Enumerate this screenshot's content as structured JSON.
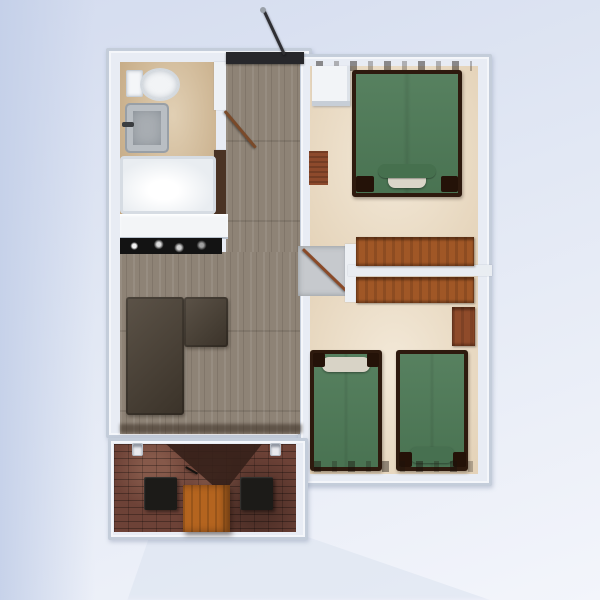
{
  "meta": {
    "view": "top-down-floorplan-render",
    "canvas": {
      "width": 600,
      "height": 600
    }
  },
  "palette": {
    "background_top": "#d4dcef",
    "background_bottom": "#f3f5fb",
    "wall_outer": "#c4cdda",
    "wall_inner": "#eef1f6",
    "bathroom_floor": "#d5bd97",
    "wood_floor": "#8e8376",
    "carpet": "#eee0c9",
    "brick": "#6d4237",
    "bed_green": "#4e7a57",
    "bed_frame": "#2e1a0e",
    "dresser_wood": "#a05726",
    "sofa_brown": "#493f33",
    "table_orange": "#b4641f",
    "chair_black": "#1c1b18",
    "counter_black": "#131313",
    "fixture_white": "#f3f5f8"
  },
  "rooms": [
    {
      "name": "bathroom",
      "fixtures": [
        "toilet",
        "sink",
        "bathtub"
      ]
    },
    {
      "name": "living-room",
      "fixtures": [
        "sofa-sectional",
        "kitchen-counter"
      ]
    },
    {
      "name": "bedroom-top",
      "fixtures": [
        "double-bed",
        "white-dresser",
        "long-dresser",
        "small-rug"
      ]
    },
    {
      "name": "bedroom-bottom",
      "fixtures": [
        "single-bed-left",
        "single-bed-right",
        "long-dresser",
        "nightstand"
      ]
    },
    {
      "name": "patio",
      "fixtures": [
        "square-table",
        "chair-left",
        "chair-right",
        "wall-lamp-left",
        "wall-lamp-right"
      ]
    }
  ],
  "scene": {
    "items": [
      {
        "name": "background",
        "kind": "bg-main",
        "x": 0,
        "y": 0,
        "w": 600,
        "h": 600,
        "interactable": false
      },
      {
        "name": "background-left-band",
        "kind": "bg-left-band",
        "x": 0,
        "y": 0,
        "w": 95,
        "h": 600,
        "opacity": 0.9,
        "interactable": false
      },
      {
        "name": "ground-shadow",
        "kind": "ground-shadow",
        "x": 120,
        "y": 536,
        "w": 370,
        "h": 64,
        "color": "#dfe5f1",
        "opacity": 0.7,
        "interactable": false
      },
      {
        "name": "living-block-walls",
        "kind": "block",
        "x": 106,
        "y": 48,
        "w": 206,
        "h": 390,
        "interactable": false
      },
      {
        "name": "bedroom-block-walls",
        "kind": "block",
        "x": 298,
        "y": 54,
        "w": 194,
        "h": 432,
        "interactable": false
      },
      {
        "name": "patio-walls",
        "kind": "block",
        "x": 108,
        "y": 438,
        "w": 200,
        "h": 102,
        "interactable": false
      },
      {
        "name": "bathroom-floor",
        "kind": "floor-tile",
        "x": 120,
        "y": 62,
        "w": 96,
        "h": 152,
        "color": "#d5bd97",
        "interactable": false
      },
      {
        "name": "hallway-wood-floor",
        "kind": "floor-wood",
        "x": 226,
        "y": 62,
        "w": 74,
        "h": 372,
        "color": "#8e8376",
        "interactable": false
      },
      {
        "name": "living-wood-floor",
        "kind": "floor-wood",
        "x": 120,
        "y": 252,
        "w": 180,
        "h": 182,
        "color": "#8e8376",
        "interactable": false
      },
      {
        "name": "bathroom-wall-segment",
        "kind": "wall",
        "x": 214,
        "y": 62,
        "w": 12,
        "h": 48,
        "color": "#eef1f5",
        "interactable": false
      },
      {
        "name": "bathroom-cabinet-strip",
        "kind": "wall",
        "x": 214,
        "y": 150,
        "w": 12,
        "h": 64,
        "color": "#4a3324",
        "interactable": true
      },
      {
        "name": "bathroom-door-leaf",
        "kind": "door-leaf",
        "x": 226,
        "y": 110,
        "w": 48,
        "h": 3,
        "rot": 50,
        "color": "#7a4a2a",
        "interactable": true
      },
      {
        "name": "bathtub",
        "kind": "tub",
        "x": 120,
        "y": 156,
        "w": 96,
        "h": 58,
        "color": "#e9edf1",
        "interactable": true
      },
      {
        "name": "toilet-tank",
        "kind": "toilet-tank",
        "x": 126,
        "y": 70,
        "w": 17,
        "h": 27,
        "color": "#f4f6f8",
        "interactable": true
      },
      {
        "name": "toilet-bowl",
        "kind": "toilet-bowl",
        "x": 140,
        "y": 68,
        "w": 40,
        "h": 33,
        "color": "#f2f4f6",
        "interactable": true
      },
      {
        "name": "sink",
        "kind": "sink",
        "x": 125,
        "y": 103,
        "w": 44,
        "h": 50,
        "color": "#a9aeb3",
        "interactable": true
      },
      {
        "name": "sink-faucet",
        "kind": "faucet",
        "x": 122,
        "y": 122,
        "w": 12,
        "h": 5,
        "color": "#3a3d40",
        "interactable": false
      },
      {
        "name": "kitchen-counter",
        "kind": "counter",
        "x": 120,
        "y": 214,
        "w": 108,
        "h": 25,
        "color": "#f3f5f7",
        "interactable": true
      },
      {
        "name": "kitchen-counter-black",
        "kind": "counter-black",
        "x": 120,
        "y": 238,
        "w": 102,
        "h": 16,
        "color": "#131313",
        "interactable": true
      },
      {
        "name": "entry-threshold",
        "kind": "threshold",
        "x": 226,
        "y": 52,
        "w": 78,
        "h": 12,
        "color": "#27272b",
        "interactable": false
      },
      {
        "name": "entry-door-leaf",
        "kind": "door-leaf",
        "x": 262,
        "y": 10,
        "w": 3,
        "h": 50,
        "rot": -25,
        "color": "#2f2f33",
        "interactable": true
      },
      {
        "name": "entry-door-handle",
        "kind": "handle-dot",
        "x": 260,
        "y": 7,
        "w": 6,
        "h": 6,
        "color": "#9aa0a8",
        "interactable": false
      },
      {
        "name": "sofa-sectional-main",
        "kind": "sofa",
        "x": 126,
        "y": 297,
        "w": 58,
        "h": 118,
        "color": "#493f33",
        "interactable": true
      },
      {
        "name": "sofa-sectional-chaise",
        "kind": "sofa",
        "x": 184,
        "y": 297,
        "w": 44,
        "h": 50,
        "color": "#493f33",
        "interactable": true
      },
      {
        "name": "living-bottom-shadow",
        "kind": "shadow-soft",
        "x": 120,
        "y": 424,
        "w": 182,
        "h": 9,
        "color": "rgba(48,36,26,0.5)",
        "interactable": false
      },
      {
        "name": "bedroom-top-carpet",
        "kind": "floor-carpet",
        "x": 310,
        "y": 66,
        "w": 168,
        "h": 202,
        "color": "#eee0c9",
        "interactable": false
      },
      {
        "name": "bedroom-bottom-carpet",
        "kind": "floor-carpet",
        "x": 310,
        "y": 274,
        "w": 168,
        "h": 200,
        "color": "#eee0c9",
        "interactable": false
      },
      {
        "name": "bedroom-landing-tile",
        "kind": "landing-tile",
        "x": 298,
        "y": 246,
        "w": 50,
        "h": 50,
        "color": "#c6c9cd",
        "interactable": false
      },
      {
        "name": "bedroom-door-leaf",
        "kind": "door-leaf",
        "x": 304,
        "y": 248,
        "w": 60,
        "h": 3,
        "rot": 44,
        "color": "#8a4a28",
        "interactable": true
      },
      {
        "name": "bedroom-wall-post",
        "kind": "wall",
        "x": 345,
        "y": 244,
        "w": 11,
        "h": 58,
        "color": "#edf0f4",
        "interactable": false
      },
      {
        "name": "bedroom-divider-wall",
        "kind": "wall",
        "x": 348,
        "y": 265,
        "w": 144,
        "h": 11,
        "color": "#e9edf2",
        "interactable": false
      },
      {
        "name": "top-wall-clutter",
        "kind": "clutter",
        "x": 316,
        "y": 61,
        "w": 156,
        "h": 10,
        "opacity": 0.7,
        "interactable": false
      },
      {
        "name": "white-dresser",
        "kind": "white-dresser",
        "x": 312,
        "y": 66,
        "w": 38,
        "h": 40,
        "color": "#f2f4f7",
        "interactable": true
      },
      {
        "name": "small-rug",
        "kind": "rug-small",
        "x": 309,
        "y": 151,
        "w": 19,
        "h": 34,
        "color": "#8d4a2c",
        "interactable": true
      },
      {
        "name": "double-bed",
        "kind": "bed",
        "x": 352,
        "y": 70,
        "w": 110,
        "h": 127,
        "color": "#4e7a57",
        "interactable": true
      },
      {
        "name": "double-bed-pillow",
        "kind": "pillow",
        "x": 388,
        "y": 170,
        "w": 38,
        "h": 18,
        "color": "#dad5c8",
        "interactable": false
      },
      {
        "name": "double-bed-duvet-fold",
        "kind": "duvet-fold",
        "x": 378,
        "y": 164,
        "w": 58,
        "h": 14,
        "color": "#46704e",
        "interactable": false
      },
      {
        "name": "double-bed-post-left",
        "kind": "post",
        "x": 356,
        "y": 176,
        "w": 18,
        "h": 16,
        "color": "#241208",
        "interactable": false
      },
      {
        "name": "double-bed-post-right",
        "kind": "post",
        "x": 441,
        "y": 176,
        "w": 17,
        "h": 16,
        "color": "#241208",
        "interactable": false
      },
      {
        "name": "dresser-top-bedroom",
        "kind": "dresser",
        "x": 356,
        "y": 237,
        "w": 118,
        "h": 29,
        "color": "#a05726",
        "interactable": true
      },
      {
        "name": "dresser-bottom-bedroom",
        "kind": "dresser",
        "x": 356,
        "y": 277,
        "w": 118,
        "h": 26,
        "color": "#a05726",
        "interactable": true
      },
      {
        "name": "nightstand",
        "kind": "dresser",
        "x": 452,
        "y": 307,
        "w": 23,
        "h": 39,
        "color": "#8f4b2a",
        "interactable": true
      },
      {
        "name": "single-bed-left",
        "kind": "bed",
        "x": 310,
        "y": 350,
        "w": 72,
        "h": 121,
        "color": "#4e7a57",
        "interactable": true
      },
      {
        "name": "single-bed-left-pillow",
        "kind": "pillow",
        "x": 322,
        "y": 357,
        "w": 48,
        "h": 15,
        "color": "#d8d3c6",
        "interactable": false
      },
      {
        "name": "single-bed-left-post-l",
        "kind": "post",
        "x": 313,
        "y": 353,
        "w": 12,
        "h": 14,
        "color": "#241208",
        "interactable": false
      },
      {
        "name": "single-bed-left-post-r",
        "kind": "post",
        "x": 367,
        "y": 353,
        "w": 12,
        "h": 14,
        "color": "#241208",
        "interactable": false
      },
      {
        "name": "single-bed-right",
        "kind": "bed",
        "x": 396,
        "y": 350,
        "w": 72,
        "h": 121,
        "color": "#4e7a57",
        "interactable": true
      },
      {
        "name": "single-bed-right-pillow",
        "kind": "pillow",
        "x": 410,
        "y": 447,
        "w": 44,
        "h": 16,
        "color": "#477050",
        "interactable": false
      },
      {
        "name": "single-bed-right-post-l",
        "kind": "post",
        "x": 399,
        "y": 452,
        "w": 13,
        "h": 15,
        "color": "#241208",
        "interactable": false
      },
      {
        "name": "single-bed-right-post-r",
        "kind": "post",
        "x": 453,
        "y": 452,
        "w": 13,
        "h": 15,
        "color": "#241208",
        "interactable": false
      },
      {
        "name": "bottom-wall-clutter",
        "kind": "clutter",
        "x": 314,
        "y": 461,
        "w": 162,
        "h": 11,
        "opacity": 0.65,
        "interactable": false
      },
      {
        "name": "patio-brick-floor",
        "kind": "floor-brick",
        "x": 114,
        "y": 444,
        "w": 182,
        "h": 88,
        "color": "#6d4237",
        "interactable": false
      },
      {
        "name": "patio-door-shadow",
        "kind": "v-shadow",
        "x": 166,
        "y": 444,
        "w": 96,
        "h": 50,
        "color": "#35201a",
        "opacity": 0.9,
        "interactable": false
      },
      {
        "name": "patio-door-handle",
        "kind": "door-leaf",
        "x": 186,
        "y": 466,
        "w": 14,
        "h": 2,
        "rot": 30,
        "color": "#15120f",
        "interactable": false
      },
      {
        "name": "wall-lamp-left",
        "kind": "lamp",
        "x": 132,
        "y": 443,
        "w": 11,
        "h": 13,
        "color": "#e9eaee",
        "interactable": true
      },
      {
        "name": "wall-lamp-right",
        "kind": "lamp",
        "x": 270,
        "y": 443,
        "w": 11,
        "h": 13,
        "color": "#e9eaee",
        "interactable": true
      },
      {
        "name": "patio-chair-left",
        "kind": "chair",
        "x": 144,
        "y": 477,
        "w": 33,
        "h": 33,
        "color": "#1c1b18",
        "interactable": true
      },
      {
        "name": "patio-chair-right",
        "kind": "chair",
        "x": 240,
        "y": 477,
        "w": 33,
        "h": 33,
        "color": "#1c1b18",
        "interactable": true
      },
      {
        "name": "patio-table",
        "kind": "table",
        "x": 183,
        "y": 485,
        "w": 47,
        "h": 47,
        "color": "#b4641f",
        "interactable": true
      }
    ]
  }
}
